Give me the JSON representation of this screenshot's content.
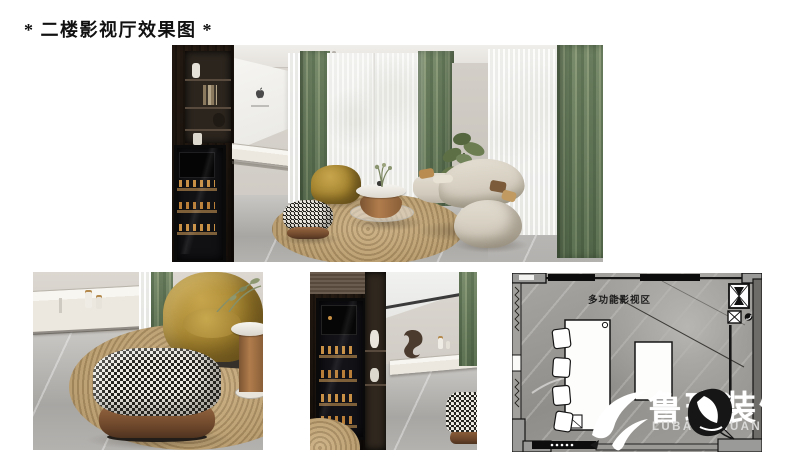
{
  "page": {
    "title": "* 二楼影视厅效果图 *"
  },
  "floor_plan": {
    "room_label": "多功能影视区"
  },
  "watermark": {
    "brand_cn": "鲁班装饰",
    "brand_en": "LUBAN ZHUANGS"
  },
  "icons": {
    "screen_logo": "apple-logo-icon",
    "watermark_logo": "luban-swoosh-icon",
    "watermark_splash": "ink-splash-icon"
  },
  "colors": {
    "curtain_sage": "#9fae9a",
    "cabinet_wood": "#4a3e33",
    "armchair_mustard": "#ab8b3e",
    "rug_jute": "#bfa67c",
    "sofa_beige": "#d8d2c6",
    "floor_marble": "#b3b1ae",
    "pouf_leather": "#8d5f3f",
    "plan_wall": "#141414"
  }
}
